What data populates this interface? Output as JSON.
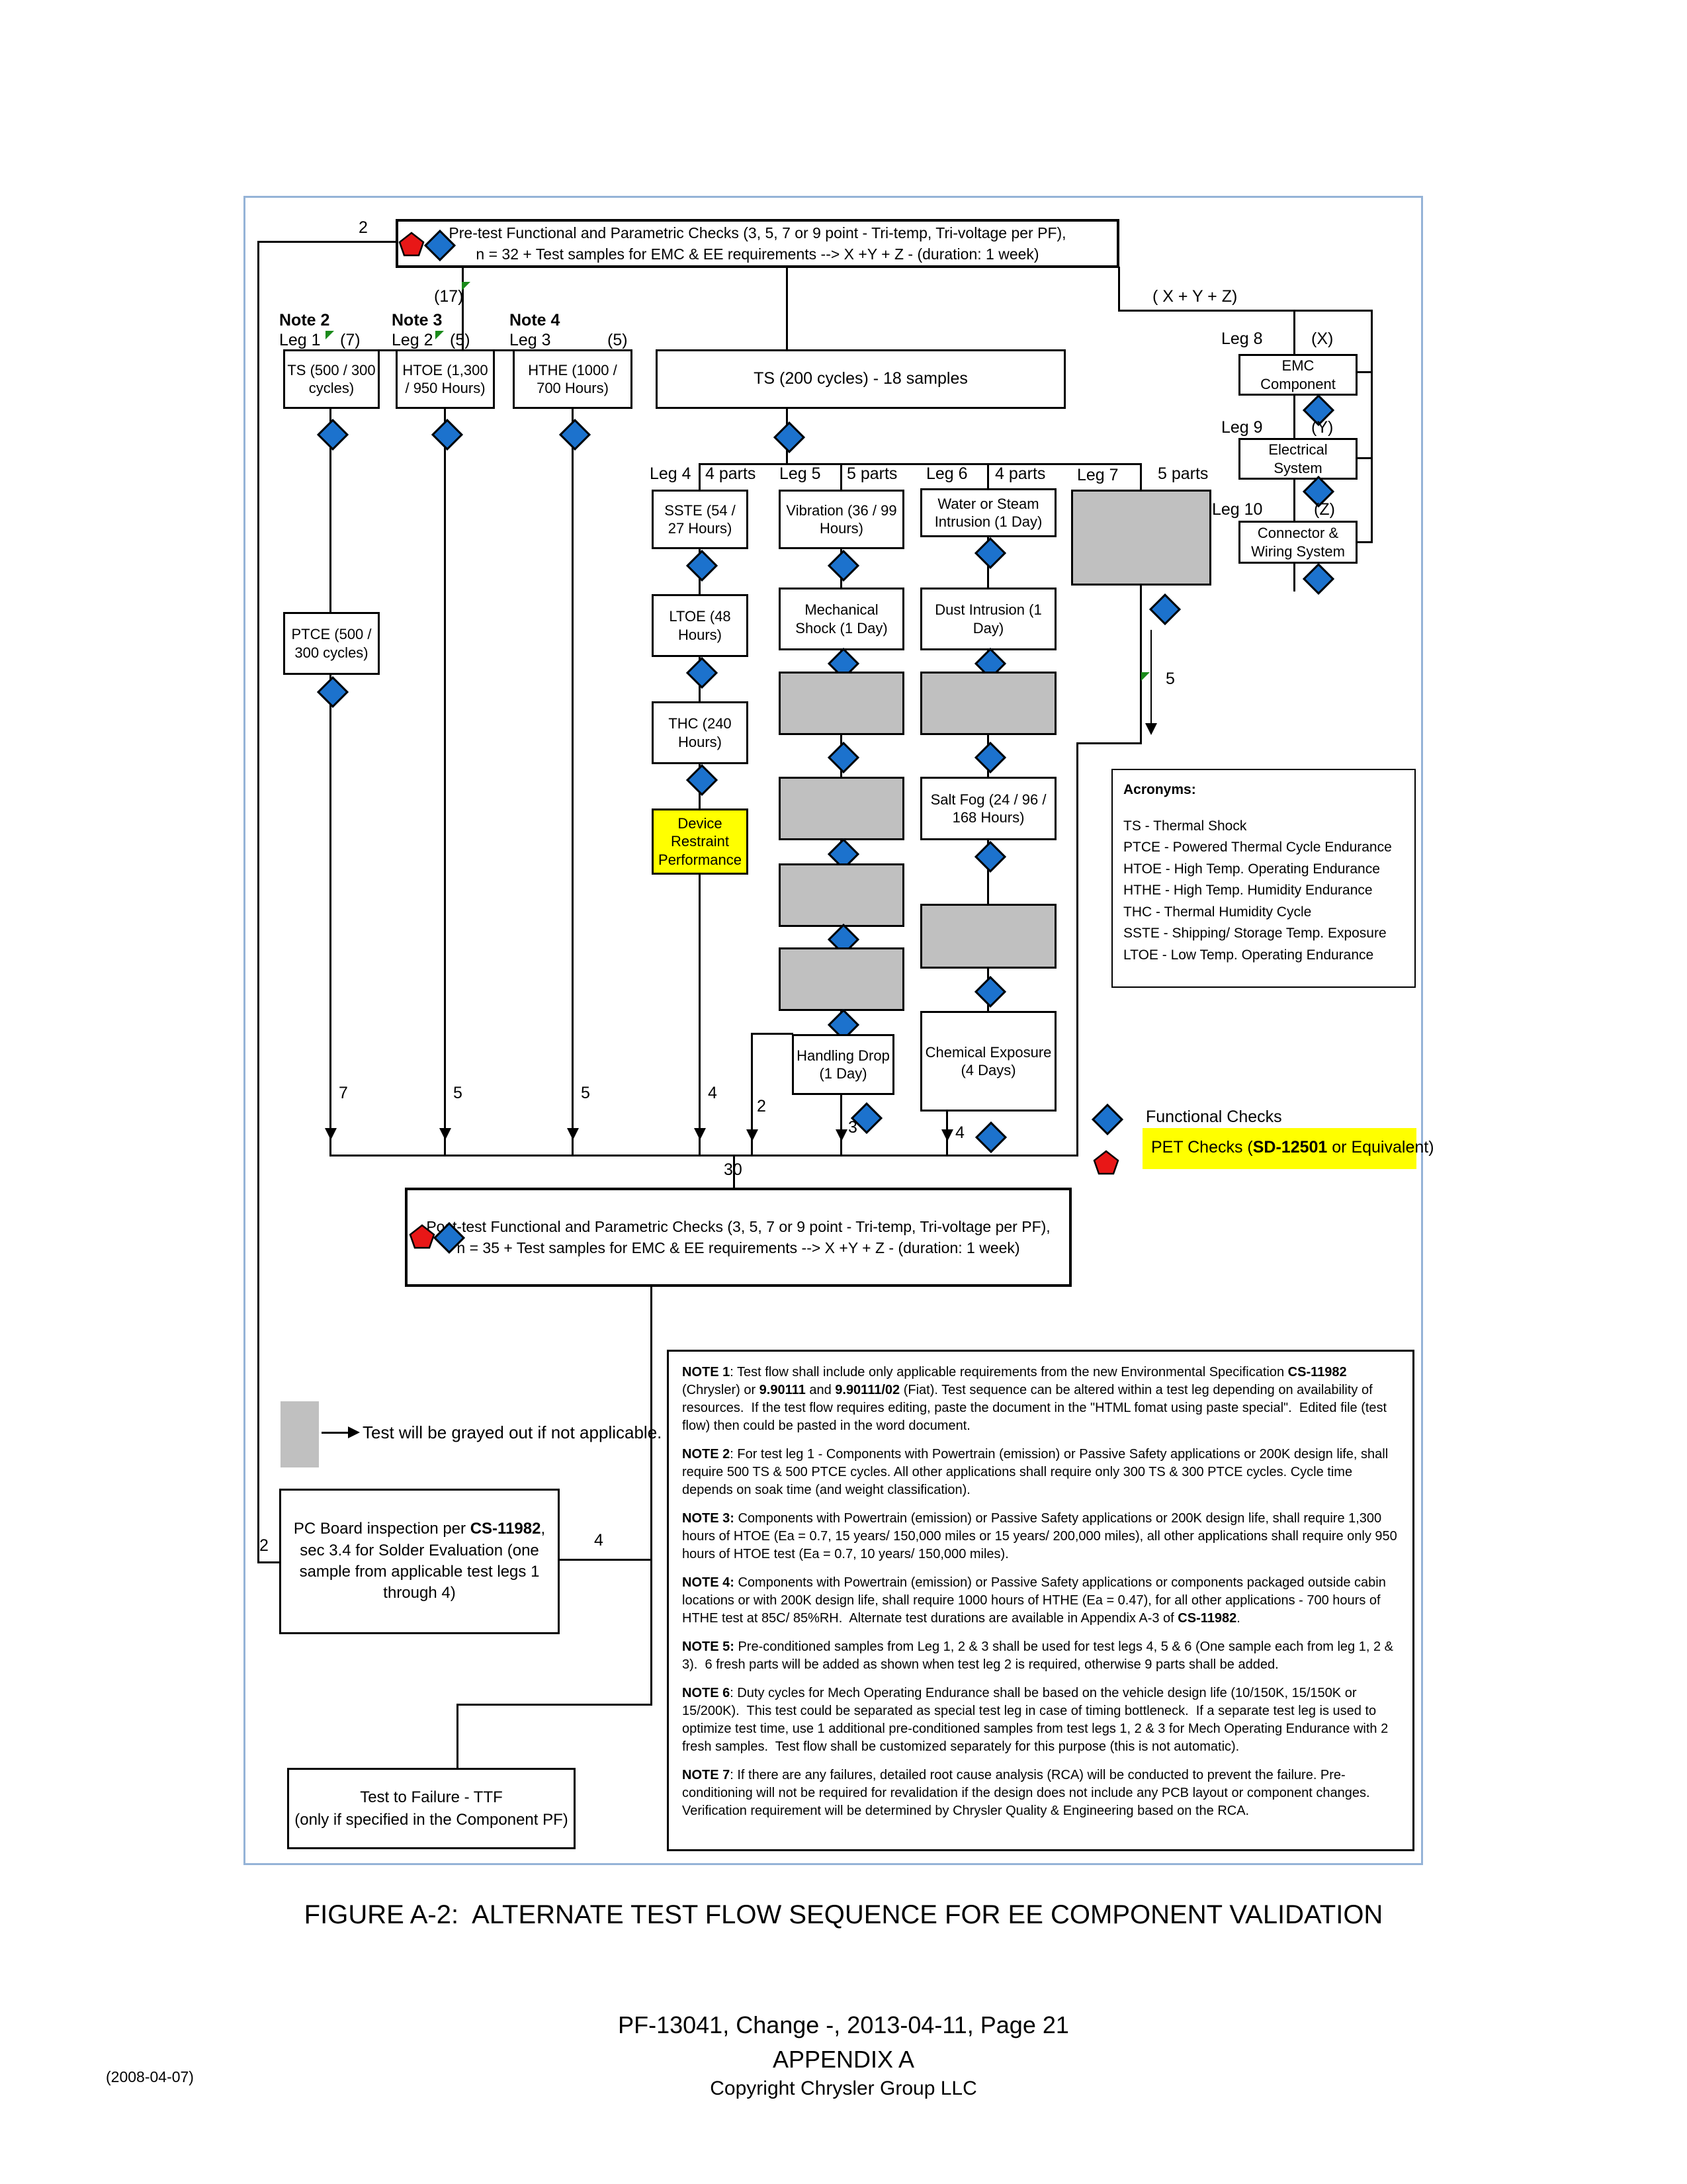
{
  "pretest": {
    "count": "2",
    "line1": "Pre-test Functional and Parametric Checks (3, 5, 7 or 9 point - Tri-temp, Tri-voltage per PF),",
    "line2": "n = 32 + Test samples for EMC & EE requirements --> X +Y + Z  - (duration: 1 week)"
  },
  "posttest": {
    "line1": "Post-test Functional and Parametric Checks (3, 5, 7 or 9 point - Tri-temp, Tri-voltage per PF),",
    "line2": "n = 35 + Test samples for EMC & EE requirements --> X +Y + Z  - (duration: 1 week)",
    "total_in": "30"
  },
  "branch": {
    "n17": "(17)",
    "xyz": "( X + Y + Z)"
  },
  "legs": {
    "leg1": {
      "note": "Note 2",
      "name": "Leg 1",
      "n": "(7)",
      "out": "7"
    },
    "leg2": {
      "note": "Note 3",
      "name": "Leg 2",
      "n": "(5)",
      "out": "5"
    },
    "leg3": {
      "note": "Note 4",
      "name": "Leg 3",
      "n": "(5)",
      "out": "5"
    },
    "leg4": {
      "name": "Leg 4",
      "n": "4 parts",
      "out": "4"
    },
    "leg5": {
      "name": "Leg 5",
      "n": "5 parts",
      "skip_out": "2",
      "drop_out": "3"
    },
    "leg6": {
      "name": "Leg 6",
      "n": "4 parts",
      "out": "4"
    },
    "leg7": {
      "name": "Leg 7",
      "n": "5 parts",
      "out": "5"
    },
    "leg8": {
      "name": "Leg 8",
      "n": "(X)"
    },
    "leg9": {
      "name": "Leg 9",
      "n": "(Y)"
    },
    "leg10": {
      "name": "Leg 10",
      "n": "(Z)"
    }
  },
  "boxes": {
    "ts": "TS (500 / 300 cycles)",
    "htoe": "HTOE (1,300 / 950 Hours)",
    "hthe": "HTHE (1000 / 700 Hours)",
    "ts200": "TS (200 cycles) - 18 samples",
    "ptce": "PTCE (500 / 300 cycles)",
    "sste": "SSTE (54 / 27 Hours)",
    "ltoe": "LTOE (48 Hours)",
    "thc": "THC (240 Hours)",
    "device_restraint": "Device Restraint Performance",
    "vibration": "Vibration (36 / 99 Hours)",
    "mech_shock": "Mechanical Shock (1 Day)",
    "water_steam": "Water or Steam Intrusion (1 Day)",
    "dust": "Dust Intrusion (1 Day)",
    "salt_fog": "Salt Fog (24 / 96 / 168 Hours)",
    "handling_drop": "Handling Drop (1 Day)",
    "chemical": "Chemical Exposure (4 Days)",
    "emc": "EMC Component",
    "electrical": "Electrical System",
    "connector": "Connector & Wiring System",
    "ttf_line1": "Test to Failure - TTF",
    "ttf_line2": "(only if specified in the Component PF)"
  },
  "pc_board": {
    "left_count": "2",
    "right_count": "4",
    "segments": [
      {
        "text": "PC Board inspection per ",
        "bold": false
      },
      {
        "text": "CS-11982",
        "bold": true
      },
      {
        "text": ", sec 3.4 for Solder Evaluation (one sample from applicable test legs 1 through 4)",
        "bold": false
      }
    ]
  },
  "legend": {
    "functional": "Functional Checks",
    "pet_segments": [
      {
        "text": "PET Checks (",
        "bold": false
      },
      {
        "text": "SD-12501",
        "bold": true
      },
      {
        "text": " or Equivalent)",
        "bold": false
      }
    ],
    "grayed_note": "Test will be grayed out if not applicable."
  },
  "acronyms": {
    "title": "Acronyms:",
    "items": [
      "TS - Thermal Shock",
      "PTCE - Powered Thermal Cycle Endurance",
      "HTOE - High Temp. Operating Endurance",
      "HTHE - High Temp. Humidity Endurance",
      "THC - Thermal Humidity Cycle",
      "SSTE - Shipping/ Storage Temp. Exposure",
      "LTOE - Low Temp. Operating Endurance"
    ]
  },
  "notes": [
    [
      {
        "text": "NOTE 1",
        "bold": true
      },
      {
        "text": ": Test flow shall include only applicable requirements from the new Environmental Specification ",
        "bold": false
      },
      {
        "text": "CS-11982",
        "bold": true
      },
      {
        "text": " (Chrysler) or ",
        "bold": false
      },
      {
        "text": "9.90111",
        "bold": true
      },
      {
        "text": " and ",
        "bold": false
      },
      {
        "text": "9.90111/02",
        "bold": true
      },
      {
        "text": " (Fiat). Test sequence can be altered within a test leg depending on availability of resources.  If the test flow requires editing, paste the document in the \"HTML fomat using paste special\".  Edited file (test flow) then could be pasted in the word document.",
        "bold": false
      }
    ],
    [
      {
        "text": "NOTE 2",
        "bold": true
      },
      {
        "text": ": For test leg 1 - Components with Powertrain (emission) or Passive Safety applications or 200K design life, shall require 500 TS & 500 PTCE cycles. All other applications shall require only 300 TS & 300 PTCE cycles. Cycle time depends on soak time (and weight classification).",
        "bold": false
      }
    ],
    [
      {
        "text": "NOTE 3:",
        "bold": true
      },
      {
        "text": " Components with Powertrain (emission) or Passive Safety applications or 200K design life, shall require 1,300 hours of HTOE (Ea = 0.7, 15 years/ 150,000 miles or 15 years/ 200,000 miles), all other applications shall require only 950 hours of HTOE test (Ea = 0.7, 10 years/ 150,000 miles).",
        "bold": false
      }
    ],
    [
      {
        "text": "NOTE 4:",
        "bold": true
      },
      {
        "text": " Components with Powertrain (emission) or Passive Safety applications or components packaged outside cabin locations or with 200K design life, shall require 1000 hours of HTHE (Ea = 0.47), for all other applications - 700 hours of HTHE test at 85C/ 85%RH.  Alternate test durations are available in Appendix A-3 of ",
        "bold": false
      },
      {
        "text": "CS-11982",
        "bold": true
      },
      {
        "text": ".",
        "bold": false
      }
    ],
    [
      {
        "text": "NOTE 5:",
        "bold": true
      },
      {
        "text": " Pre-conditioned samples from Leg 1, 2 & 3 shall be used for test legs 4, 5 & 6 (One sample each from leg 1, 2 & 3).  6 fresh parts will be added as shown when test leg 2 is required, otherwise 9 parts shall be added.",
        "bold": false
      }
    ],
    [
      {
        "text": "NOTE 6",
        "bold": true
      },
      {
        "text": ": Duty cycles for Mech Operating Endurance shall be based on the vehicle design life (10/150K, 15/150K or 15/200K).  This test could be separated as special test leg in case of timing bottleneck.  If a separate test leg is used to optimize test time, use 1 additional pre-conditioned samples from test legs 1, 2 & 3 for Mech Operating Endurance with 2 fresh samples.  Test flow shall be customized separately for this purpose (this is not automatic).",
        "bold": false
      }
    ],
    [
      {
        "text": "NOTE 7",
        "bold": true
      },
      {
        "text": ": If there are any failures, detailed root cause analysis (RCA) will be conducted to prevent the failure. Pre-conditioning will not be required for revalidation if the design does not include any PCB layout or component changes. Verification requirement will be determined by Chrysler Quality & Engineering based on the RCA.",
        "bold": false
      }
    ]
  ],
  "footer": {
    "figure_title": "FIGURE A-2:  ALTERNATE TEST FLOW SEQUENCE FOR EE COMPONENT VALIDATION",
    "doc_line": "PF-13041, Change -, 2013-04-11, Page 21",
    "appendix": "APPENDIX A",
    "copyright": "Copyright Chrysler Group LLC",
    "date_note": "(2008-04-07)"
  }
}
